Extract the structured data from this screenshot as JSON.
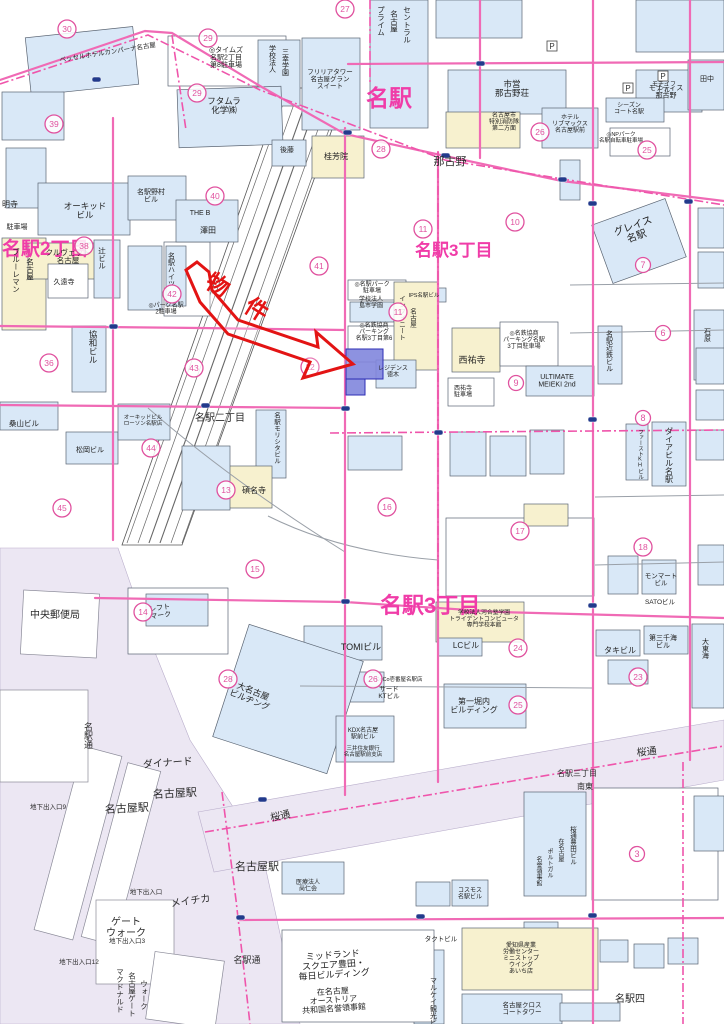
{
  "map": {
    "colors": {
      "road_pink": "#f06ab5",
      "boundary_pink": "#ef55ab",
      "district_pink": "#f03ca8",
      "circle_pink": "#e0529f",
      "building_blue": "#d9e8f7",
      "building_cream": "#f7f1cf",
      "station_lavender": "#ece7f3",
      "parcel_blue": "#8186dd",
      "arrow_red": "#e31414",
      "signal_navy": "#223a8c"
    },
    "property": {
      "label": "物　件",
      "x": 233,
      "y": 304,
      "rot": 32,
      "size": 23
    },
    "p_mark_glyph": "P",
    "p_marks": [
      {
        "x": 552,
        "y": 46
      },
      {
        "x": 628,
        "y": 88
      },
      {
        "x": 663,
        "y": 76
      }
    ],
    "district_labels": [
      {
        "t": "名駅2丁目",
        "x": 2,
        "y": 255,
        "s": 19,
        "a": "s"
      },
      {
        "t": "名駅",
        "x": 366,
        "y": 106,
        "s": 23,
        "a": "s"
      },
      {
        "t": "名駅3丁目",
        "x": 415,
        "y": 256,
        "s": 17,
        "a": "s"
      },
      {
        "t": "名駅3丁目",
        "x": 380,
        "y": 613,
        "s": 22,
        "a": "s"
      }
    ],
    "street_labels": [
      {
        "t": "那古野",
        "x": 450,
        "y": 165,
        "s": 11
      },
      {
        "t": "名駅二丁目",
        "x": 220,
        "y": 421,
        "s": 10
      },
      {
        "t": "桜通",
        "x": 281,
        "y": 819,
        "s": 10,
        "r": -12
      },
      {
        "t": "桜通",
        "x": 647,
        "y": 755,
        "s": 10,
        "r": -6
      },
      {
        "t": "名駅通",
        "x": 88,
        "y": 722,
        "s": 9,
        "v": 1
      },
      {
        "t": "名駅通",
        "x": 247,
        "y": 963,
        "s": 9
      },
      {
        "t": "中央郵便局",
        "x": 55,
        "y": 618,
        "s": 10
      },
      {
        "t": "ダイナード",
        "x": 168,
        "y": 766,
        "s": 10,
        "r": -4
      },
      {
        "t": "名古屋駅",
        "x": 127,
        "y": 812,
        "s": 11,
        "r": -3
      },
      {
        "t": "名古屋駅",
        "x": 175,
        "y": 797,
        "s": 11,
        "r": -3
      },
      {
        "t": "名古屋駅",
        "x": 257,
        "y": 870,
        "s": 11
      },
      {
        "t": "メイチカ",
        "x": 191,
        "y": 904,
        "s": 10,
        "r": -8
      },
      {
        "t": "ゲート\nウォーク",
        "x": 126,
        "y": 925,
        "s": 10
      },
      {
        "t": "名駅三丁目",
        "x": 577,
        "y": 776,
        "s": 8
      },
      {
        "t": "南東",
        "x": 585,
        "y": 789,
        "s": 8
      },
      {
        "t": "名駅四",
        "x": 630,
        "y": 1002,
        "s": 10
      },
      {
        "t": "地下出入口9",
        "x": 48,
        "y": 809,
        "s": 6.5
      },
      {
        "t": "地下出入口",
        "x": 146,
        "y": 894,
        "s": 6.5
      },
      {
        "t": "地下出入口3",
        "x": 127,
        "y": 943,
        "s": 6.5
      },
      {
        "t": "地下出入口12",
        "x": 79,
        "y": 964,
        "s": 6.5
      },
      {
        "t": "マクドナルド",
        "x": 120,
        "y": 968,
        "s": 7.5,
        "v": 1
      },
      {
        "t": "名古屋ゲート",
        "x": 132,
        "y": 972,
        "s": 7.5,
        "v": 1
      },
      {
        "t": "ウォーク",
        "x": 144,
        "y": 980,
        "s": 7.5,
        "v": 1
      }
    ],
    "building_labels": [
      {
        "t": "ベッセルホテルカンパーナ名古屋",
        "x": 60,
        "y": 62,
        "s": 6.5,
        "r": -9,
        "a": "s"
      },
      {
        "t": "◎タイムズ\n名駅2丁目\n第8駐車場",
        "x": 226,
        "y": 52,
        "s": 7
      },
      {
        "t": "学校法人",
        "x": 272,
        "y": 45,
        "s": 7,
        "v": 1
      },
      {
        "t": "三幸学園",
        "x": 285,
        "y": 48,
        "s": 7,
        "v": 1
      },
      {
        "t": "フリリアタワー\n名古屋グラン\nスイート",
        "x": 330,
        "y": 74,
        "s": 6.5
      },
      {
        "t": "フタムラ\n化学㈱",
        "x": 224,
        "y": 104,
        "s": 8.5
      },
      {
        "t": "市営\n那古野荘",
        "x": 512,
        "y": 87,
        "s": 8.5
      },
      {
        "t": "名古屋市\n特別消防隊\n第二方面",
        "x": 504,
        "y": 117,
        "s": 6
      },
      {
        "t": "ホテル\nリブマックス\n名古屋駅前",
        "x": 570,
        "y": 119,
        "s": 6
      },
      {
        "t": "モナティス\n那古野",
        "x": 666,
        "y": 90,
        "s": 7
      },
      {
        "t": "シーズン\nコート名駅",
        "x": 629,
        "y": 107,
        "s": 6
      },
      {
        "t": "◎NPパーク\n名駅自転車駐車場",
        "x": 621,
        "y": 136,
        "s": 5.5
      },
      {
        "t": "桂芳院",
        "x": 336,
        "y": 159,
        "s": 8
      },
      {
        "t": "後藤",
        "x": 287,
        "y": 152,
        "s": 7
      },
      {
        "t": "名駅野村\nビル",
        "x": 151,
        "y": 194,
        "s": 7
      },
      {
        "t": "THE B",
        "x": 200,
        "y": 215,
        "s": 7
      },
      {
        "t": "澤田",
        "x": 208,
        "y": 233,
        "s": 8
      },
      {
        "t": "オーキッド\nビル",
        "x": 85,
        "y": 209,
        "s": 8.5
      },
      {
        "t": "駐車場",
        "x": 17,
        "y": 229,
        "s": 7
      },
      {
        "t": "明寺",
        "x": 10,
        "y": 207,
        "s": 8
      },
      {
        "t": "クルヴェット\n名古屋",
        "x": 68,
        "y": 255,
        "s": 7.5
      },
      {
        "t": "ブルーレマン",
        "x": 16,
        "y": 248,
        "s": 7.5,
        "v": 1
      },
      {
        "t": "名古屋",
        "x": 30,
        "y": 258,
        "s": 7.5,
        "v": 1
      },
      {
        "t": "辻ビル",
        "x": 102,
        "y": 247,
        "s": 7.5,
        "v": 1
      },
      {
        "t": "久遠寺",
        "x": 64,
        "y": 284,
        "s": 7
      },
      {
        "t": "名駅ハイツ",
        "x": 171,
        "y": 252,
        "s": 7,
        "v": 1
      },
      {
        "t": "◎パーク名駅\n2駐車場",
        "x": 166,
        "y": 307,
        "s": 6
      },
      {
        "t": "協和ビル",
        "x": 93,
        "y": 330,
        "s": 8.5,
        "v": 1
      },
      {
        "t": "桑山ビル",
        "x": 24,
        "y": 426,
        "s": 7.5
      },
      {
        "t": "松岡ビル",
        "x": 90,
        "y": 452,
        "s": 7
      },
      {
        "t": "オーキッドビル\nローソン名駅店",
        "x": 143,
        "y": 419,
        "s": 5.5
      },
      {
        "t": "名駅モリシタビル",
        "x": 276,
        "y": 412,
        "s": 6.5,
        "v": 1
      },
      {
        "t": "碩名寺",
        "x": 254,
        "y": 493,
        "s": 8
      },
      {
        "t": "プライム",
        "x": 381,
        "y": 6,
        "s": 7.5,
        "v": 1
      },
      {
        "t": "名古屋",
        "x": 394,
        "y": 10,
        "s": 7.5,
        "v": 1
      },
      {
        "t": "セントラル",
        "x": 407,
        "y": 6,
        "s": 7.5,
        "v": 1
      },
      {
        "t": "◎名駅パーク\n駐車場",
        "x": 372,
        "y": 286,
        "s": 6
      },
      {
        "t": "学校法人\n島市学園",
        "x": 371,
        "y": 301,
        "s": 6
      },
      {
        "t": "IPS名駅ビル",
        "x": 424,
        "y": 297,
        "s": 5.5
      },
      {
        "t": "インフィニート",
        "x": 401,
        "y": 295,
        "s": 6.5,
        "v": 1
      },
      {
        "t": "名古屋",
        "x": 412,
        "y": 308,
        "s": 6.5,
        "v": 1
      },
      {
        "t": "◎名鉄協商\nパーキング\n名駅3丁目第6",
        "x": 374,
        "y": 327,
        "s": 6
      },
      {
        "t": "レジデンス\n徳木",
        "x": 393,
        "y": 370,
        "s": 6
      },
      {
        "t": "西祐寺",
        "x": 472,
        "y": 363,
        "s": 9
      },
      {
        "t": "西祐寺\n駐車場",
        "x": 463,
        "y": 390,
        "s": 6
      },
      {
        "t": "◎名鉄協商\nパーキング名駅\n3丁目駐車場",
        "x": 524,
        "y": 335,
        "s": 6
      },
      {
        "t": "ULTIMATE\nMEIEKI 2nd",
        "x": 557,
        "y": 379,
        "s": 7
      },
      {
        "t": "名駅近鉄ビル",
        "x": 609,
        "y": 330,
        "s": 7,
        "v": 1
      },
      {
        "t": "グレイス\n名駅",
        "x": 634,
        "y": 229,
        "s": 10,
        "r": -20
      },
      {
        "t": "ダイアビル名駅",
        "x": 669,
        "y": 427,
        "s": 8,
        "v": 1
      },
      {
        "t": "ファーストKHビル",
        "x": 640,
        "y": 429,
        "s": 5.5,
        "v": 1
      },
      {
        "t": "モンマート\nビル",
        "x": 661,
        "y": 578,
        "s": 6.5
      },
      {
        "t": "SATOビル",
        "x": 660,
        "y": 604,
        "s": 6.5
      },
      {
        "t": "タキビル",
        "x": 620,
        "y": 653,
        "s": 8
      },
      {
        "t": "第三千海\nビル",
        "x": 663,
        "y": 640,
        "s": 7
      },
      {
        "t": "大東海",
        "x": 705,
        "y": 638,
        "s": 7,
        "v": 1
      },
      {
        "t": "学校法人河合塾学園\nトライデントコンピュータ\n専門学校本館",
        "x": 484,
        "y": 614,
        "s": 5.8
      },
      {
        "t": "LCビル",
        "x": 466,
        "y": 648,
        "s": 8
      },
      {
        "t": "第一堀内\nビルディング",
        "x": 474,
        "y": 704,
        "s": 8
      },
      {
        "t": "TOMIビル",
        "x": 361,
        "y": 650,
        "s": 9
      },
      {
        "t": "CoCo壱番屋名駅店",
        "x": 399,
        "y": 681,
        "s": 5.5
      },
      {
        "t": "サード\nKTビル",
        "x": 389,
        "y": 691,
        "s": 6.5
      },
      {
        "t": "大名古屋\nビルヂング",
        "x": 252,
        "y": 694,
        "s": 8.5,
        "r": 22
      },
      {
        "t": "レフト\nマーク",
        "x": 160,
        "y": 610,
        "s": 7,
        "r": -8
      },
      {
        "t": "KDX名古屋\n駅前ビル",
        "x": 363,
        "y": 732,
        "s": 6
      },
      {
        "t": "三井住友銀行\n名古屋駅前支店",
        "x": 363,
        "y": 750,
        "s": 5.5
      },
      {
        "t": "医療法人\n尚仁会",
        "x": 308,
        "y": 884,
        "s": 6
      },
      {
        "t": "コスモス\n名駅ビル",
        "x": 470,
        "y": 892,
        "s": 6
      },
      {
        "t": "タクトビル",
        "x": 441,
        "y": 941,
        "s": 6.5
      },
      {
        "t": "愛知県産業\n労働センター\nミニストップ\nウイング\nあいち店",
        "x": 521,
        "y": 947,
        "s": 6
      },
      {
        "t": "マルケイ観光ビル",
        "x": 433,
        "y": 977,
        "s": 7,
        "v": 1
      },
      {
        "t": "名古屋クロス\nコートタワー",
        "x": 522,
        "y": 1007,
        "s": 6.5
      },
      {
        "t": "ミッドランド\nスクエア豊田・\n毎日ビルディング",
        "x": 333,
        "y": 958,
        "s": 9,
        "r": -4
      },
      {
        "t": "在名古屋\nオーストリア\n共和国名誉領事館",
        "x": 333,
        "y": 994,
        "s": 8,
        "r": -4
      },
      {
        "t": "桜通豊田ビル",
        "x": 572,
        "y": 826,
        "s": 6.5,
        "v": 1
      },
      {
        "t": "在名古屋",
        "x": 560,
        "y": 838,
        "s": 6,
        "v": 1
      },
      {
        "t": "ポルトガル",
        "x": 549,
        "y": 848,
        "s": 6,
        "v": 1
      },
      {
        "t": "名誉領事館",
        "x": 538,
        "y": 856,
        "s": 6,
        "v": 1
      },
      {
        "t": "田中",
        "x": 707,
        "y": 81,
        "s": 7
      },
      {
        "t": "モチイフ\nビル",
        "x": 664,
        "y": 86,
        "s": 6
      },
      {
        "t": "石原",
        "x": 707,
        "y": 328,
        "s": 7,
        "v": 1
      }
    ],
    "circled_numbers": [
      {
        "n": "30",
        "x": 67,
        "y": 29
      },
      {
        "n": "29",
        "x": 208,
        "y": 38
      },
      {
        "n": "27",
        "x": 345,
        "y": 9
      },
      {
        "n": "29",
        "x": 197,
        "y": 93
      },
      {
        "n": "39",
        "x": 54,
        "y": 124
      },
      {
        "n": "40",
        "x": 215,
        "y": 196
      },
      {
        "n": "38",
        "x": 84,
        "y": 246
      },
      {
        "n": "28",
        "x": 381,
        "y": 149
      },
      {
        "n": "26",
        "x": 540,
        "y": 132
      },
      {
        "n": "25",
        "x": 647,
        "y": 150
      },
      {
        "n": "11",
        "x": 423,
        "y": 229
      },
      {
        "n": "10",
        "x": 515,
        "y": 222
      },
      {
        "n": "41",
        "x": 319,
        "y": 266
      },
      {
        "n": "11",
        "x": 398,
        "y": 312
      },
      {
        "n": "12",
        "x": 310,
        "y": 367
      },
      {
        "n": "43",
        "x": 194,
        "y": 368
      },
      {
        "n": "42",
        "x": 172,
        "y": 294
      },
      {
        "n": "36",
        "x": 49,
        "y": 363
      },
      {
        "n": "44",
        "x": 151,
        "y": 448
      },
      {
        "n": "45",
        "x": 62,
        "y": 508
      },
      {
        "n": "13",
        "x": 226,
        "y": 490
      },
      {
        "n": "15",
        "x": 255,
        "y": 569
      },
      {
        "n": "16",
        "x": 387,
        "y": 507
      },
      {
        "n": "17",
        "x": 520,
        "y": 531
      },
      {
        "n": "7",
        "x": 643,
        "y": 265
      },
      {
        "n": "6",
        "x": 663,
        "y": 333
      },
      {
        "n": "8",
        "x": 643,
        "y": 418
      },
      {
        "n": "9",
        "x": 516,
        "y": 383
      },
      {
        "n": "18",
        "x": 643,
        "y": 547
      },
      {
        "n": "24",
        "x": 518,
        "y": 648
      },
      {
        "n": "23",
        "x": 638,
        "y": 677
      },
      {
        "n": "25",
        "x": 518,
        "y": 705
      },
      {
        "n": "26",
        "x": 373,
        "y": 679
      },
      {
        "n": "14",
        "x": 143,
        "y": 612
      },
      {
        "n": "28",
        "x": 228,
        "y": 679
      },
      {
        "n": "3",
        "x": 637,
        "y": 854
      }
    ]
  }
}
